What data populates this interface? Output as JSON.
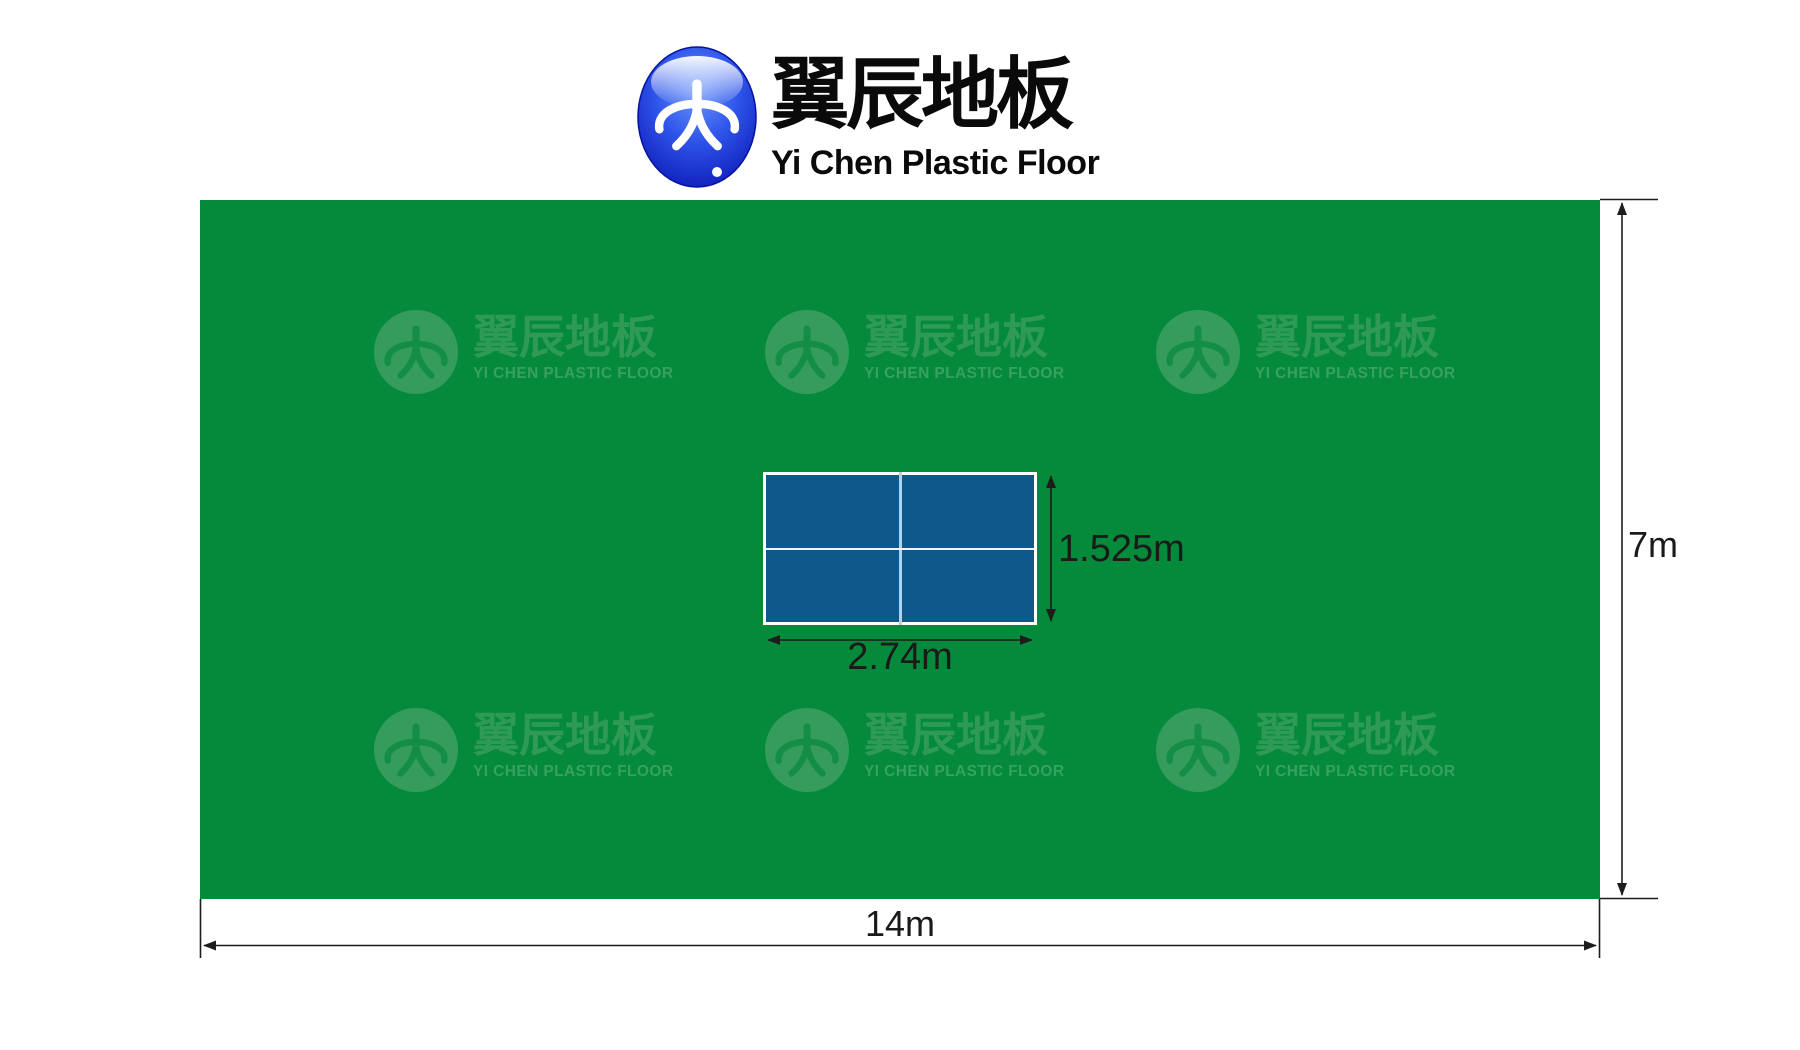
{
  "header": {
    "brand_cn": "翼辰地板",
    "brand_en": "Yi Chen Plastic Floor"
  },
  "watermark": {
    "brand_cn": "翼辰地板",
    "brand_en": "YI CHEN PLASTIC FLOOR"
  },
  "diagram": {
    "type": "table-tennis court floor plan",
    "floor": {
      "width_m": 14,
      "height_m": 7,
      "width_label": "14m",
      "height_label": "7m",
      "color": "#048a3a"
    },
    "table": {
      "width_m": 2.74,
      "height_m": 1.525,
      "width_label": "2.74m",
      "height_label": "1.525m",
      "color": "#0e598a"
    }
  },
  "colors": {
    "floor_green": "#048a3a",
    "watermark_green": "#359c5e",
    "table_blue": "#0e598a",
    "dimension_black": "#1d1d1b",
    "brand_ball_blue": "#2e55ea"
  }
}
